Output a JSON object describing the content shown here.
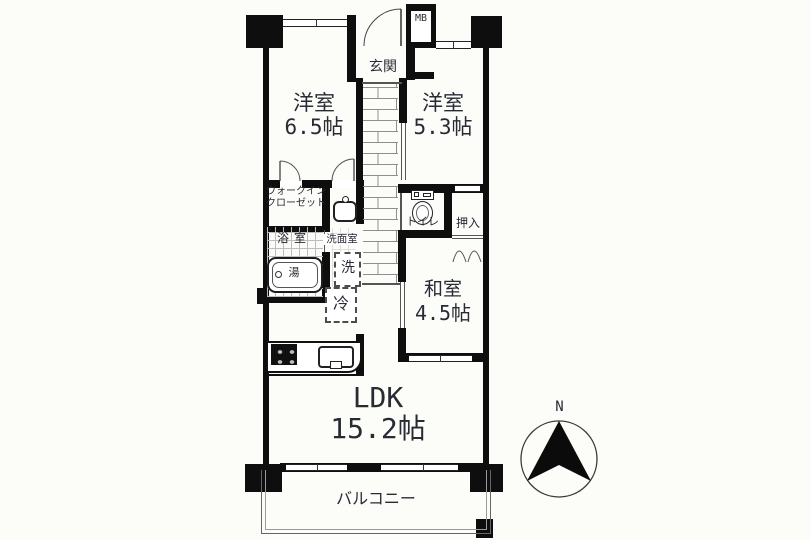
{
  "plan": {
    "rooms": {
      "bedroom1": {
        "name": "洋室",
        "size": "6.5帖"
      },
      "bedroom2": {
        "name": "洋室",
        "size": "5.3帖"
      },
      "entrance": {
        "name": "玄関"
      },
      "meter_box": {
        "abbr": "MB"
      },
      "walk_in_closet": {
        "name_line1": "ウォークイン",
        "name_line2": "クローゼット"
      },
      "bathroom": {
        "name": "浴室",
        "bathtub": "湯"
      },
      "washroom": {
        "name": "洗面室",
        "washer": "洗",
        "fridge": "冷"
      },
      "toilet": {
        "name": "トイレ"
      },
      "closet": {
        "name": "押入"
      },
      "japanese_room": {
        "name": "和室",
        "size": "4.5帖"
      },
      "living": {
        "name": "LDK",
        "size": "15.2帖"
      },
      "balcony": {
        "name": "バルコニー"
      }
    },
    "compass": {
      "north": "N"
    },
    "colors": {
      "wall": "#0e0e0e",
      "text": "#272b34",
      "line": "#555555"
    }
  }
}
